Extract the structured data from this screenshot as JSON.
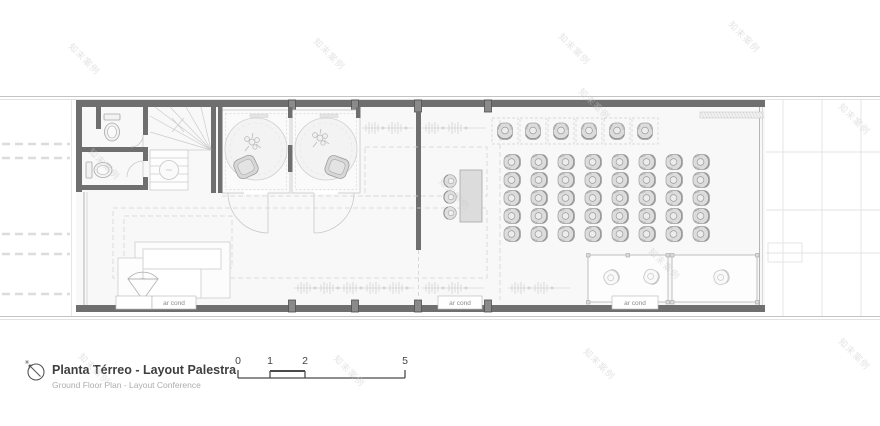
{
  "title_block": {
    "title": "Planta Térreo  - Layout Palestra",
    "subtitle": "Ground Floor Plan - Layout Conference"
  },
  "scale_bar": {
    "labels": [
      "0",
      "1",
      "2",
      "5"
    ]
  },
  "plan": {
    "ar_cond_label": "ar cond"
  },
  "watermark": {
    "text": "知末案例"
  },
  "colors": {
    "wall": "#6f6f6f",
    "furniture_line": "#9c9c9c",
    "light_line": "#c9c9c9",
    "floor": "#f8f8f8",
    "chair_fill": "#dcdcdc",
    "title_text": "#3f3f3f",
    "subtitle_text": "#adadad"
  }
}
